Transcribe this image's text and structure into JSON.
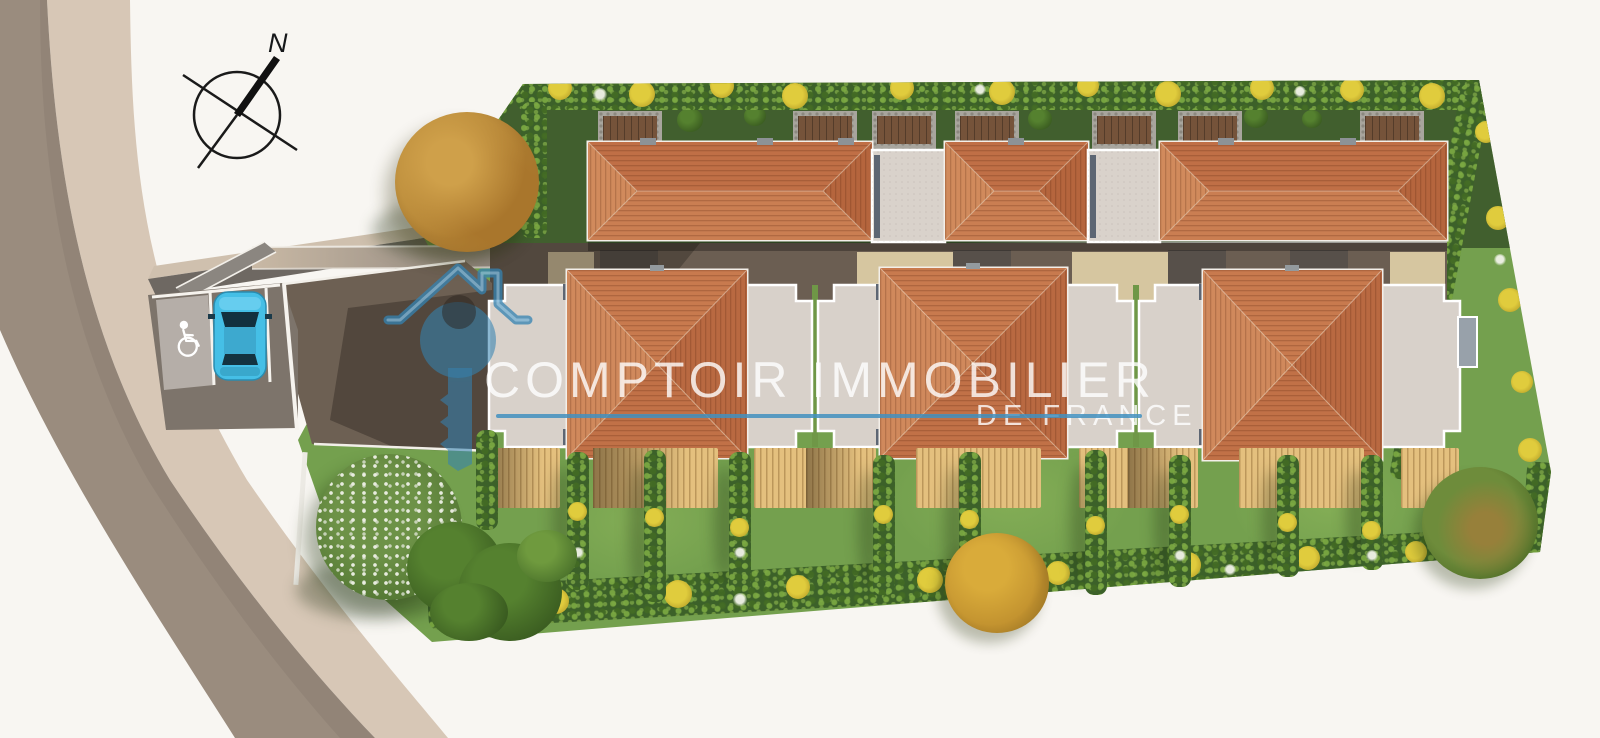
{
  "compass": {
    "north_label": "N",
    "icon": "compass-rose-icon"
  },
  "watermark": {
    "title": "COMPTOIR IMMOBILIER",
    "subtitle": "DE FRANCE",
    "logo_icon": "house-key-icon",
    "underline": true
  },
  "scene_inventory": {
    "view": "aerial site plan render",
    "long_buildings_top_row": 3,
    "detached_houses_bottom_row": 3,
    "garage_links": 2,
    "parked_cars": 1,
    "accessible_parking_space": true,
    "wheelchair_symbol": true,
    "wooden_decks": 9,
    "garden_hedgerows": 9
  },
  "palette": {
    "bg": "#f8f6f2",
    "accent": "#4291bf",
    "wm": "rgba(255,255,255,0.8)",
    "road": "#9a8c7e",
    "shoulder": "#d7c7b6",
    "lawn": "#74a04e",
    "lawn-dark": "#415f2e",
    "roof": "#c4764a",
    "flat-roof": "#d8d1ca",
    "deck": "#e4c07e",
    "car": "#45bfe6",
    "hedge": "#3c6129",
    "bloom": "#e0cc3d"
  }
}
